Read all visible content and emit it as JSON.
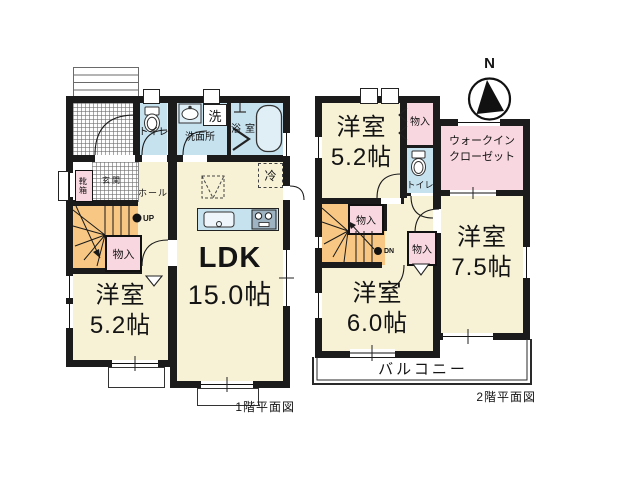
{
  "floor1": {
    "caption": "1階平面図",
    "ldk_name": "LDK",
    "ldk_size": "15.0帖",
    "room_name": "洋室",
    "room_size": "5.2帖",
    "toilet": "トイレ",
    "washroom": "洗面所",
    "washer": "洗",
    "bath": "浴室",
    "fridge": "冷",
    "entrance": "玄関",
    "shoebox": "靴箱",
    "hall": "ホール",
    "storage": "物入",
    "up": "UP"
  },
  "floor2": {
    "caption": "2階平面図",
    "room52_name": "洋室",
    "room52_size": "5.2帖",
    "room60_name": "洋室",
    "room60_size": "6.0帖",
    "room75_name": "洋室",
    "room75_size": "7.5帖",
    "wic_line1": "ウォークイン",
    "wic_line2": "クローゼット",
    "toilet": "トイレ",
    "storage_top": "物入",
    "storage_stairs": "物入",
    "storage_mid": "物入",
    "dn": "DN",
    "balcony": "バルコニー"
  },
  "compass": {
    "north_label": "N"
  },
  "colors": {
    "room_cream": "#f7f2d6",
    "water_blue": "#c7e2ef",
    "closet_pink": "#f9d7e1",
    "stairs_orange": "#f7c783",
    "wall_black": "#1b1b1b"
  }
}
